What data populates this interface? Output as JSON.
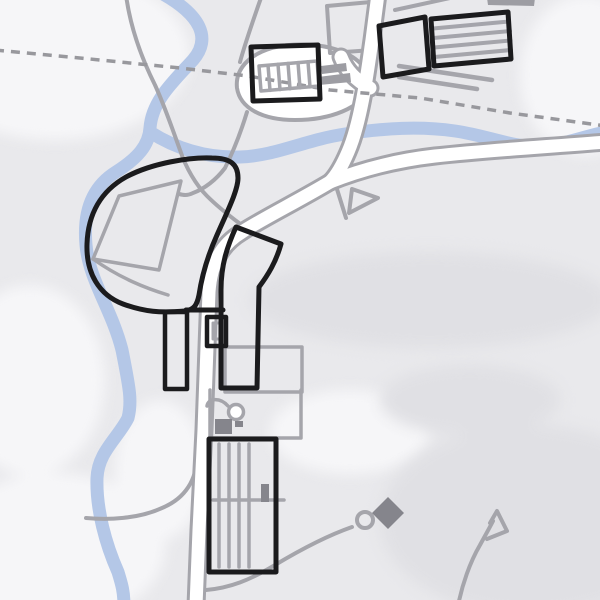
{
  "meta": {
    "kind": "map-render",
    "description": "Untextured topographic map tile with river, roads, farm enclosure and hatched industrial buildings",
    "visible_text": "none",
    "canvas": {
      "width": 600,
      "height": 600
    }
  },
  "palette": {
    "base": "#e9e9ec",
    "patch_light": "#f6f6f8",
    "patch_dark": "#e0e0e4",
    "water": "#b4c7e7",
    "road_line": "#a5a5ab",
    "road_fill": "#ffffff",
    "detail_gray": "#a5a5ab",
    "building_outline": "#1b1b1d",
    "fill_gray": "#9d9da3",
    "fill_dark_gray": "#85858c",
    "dashed_boundary": "#98989d"
  },
  "features": {
    "water": [
      {
        "name": "river-main",
        "kind": "stream",
        "course": "enters top-left-center, meanders south along west enclosure, exits bottom-left"
      },
      {
        "name": "river-east-branch",
        "kind": "stream",
        "course": "forks east below the village loop and runs to right edge above main road"
      }
    ],
    "boundary": {
      "name": "dashed-boundary-line",
      "kind": "administrative boundary",
      "course": "left edge y=50 descending to right edge y=126"
    },
    "roads": [
      {
        "name": "main-road-north",
        "kind": "white road with casing"
      },
      {
        "name": "main-road-east",
        "kind": "white road with casing"
      },
      {
        "name": "main-road-south",
        "kind": "white road with casing"
      },
      {
        "name": "village-loop",
        "kind": "white loop lane around farm buildings"
      },
      {
        "name": "west-lane",
        "kind": "minor gray road"
      },
      {
        "name": "field-tracks",
        "kind": "gray footpaths with loop, hook and flag endings"
      }
    ],
    "buildings": [
      {
        "name": "hatched-building-center-top",
        "kind": "long divided barn, black outline, internal unit dividers"
      },
      {
        "name": "black-quad-top-right",
        "kind": "building outline"
      },
      {
        "name": "hatched-building-top-right",
        "kind": "barn with horizontal hatch lines"
      },
      {
        "name": "west-enclosure",
        "kind": "large fenced paddock with tilted field inside"
      },
      {
        "name": "mid-building-complex",
        "kind": "black outlined yard with square annex"
      },
      {
        "name": "left-small-building",
        "kind": "black outlined rectangle"
      },
      {
        "name": "bottom-hatched-building",
        "kind": "large shed with vertical hatch lines"
      },
      {
        "name": "gray-footprint-buildings",
        "kind": "two gray filled bars near loop"
      }
    ],
    "markers": [
      {
        "name": "ring-symbol",
        "kind": "small circle (well/tank)"
      },
      {
        "name": "dark-square-marker",
        "kind": "filled gray square"
      },
      {
        "name": "diamond-marker",
        "kind": "filled gray diamond, bottom right"
      }
    ]
  }
}
